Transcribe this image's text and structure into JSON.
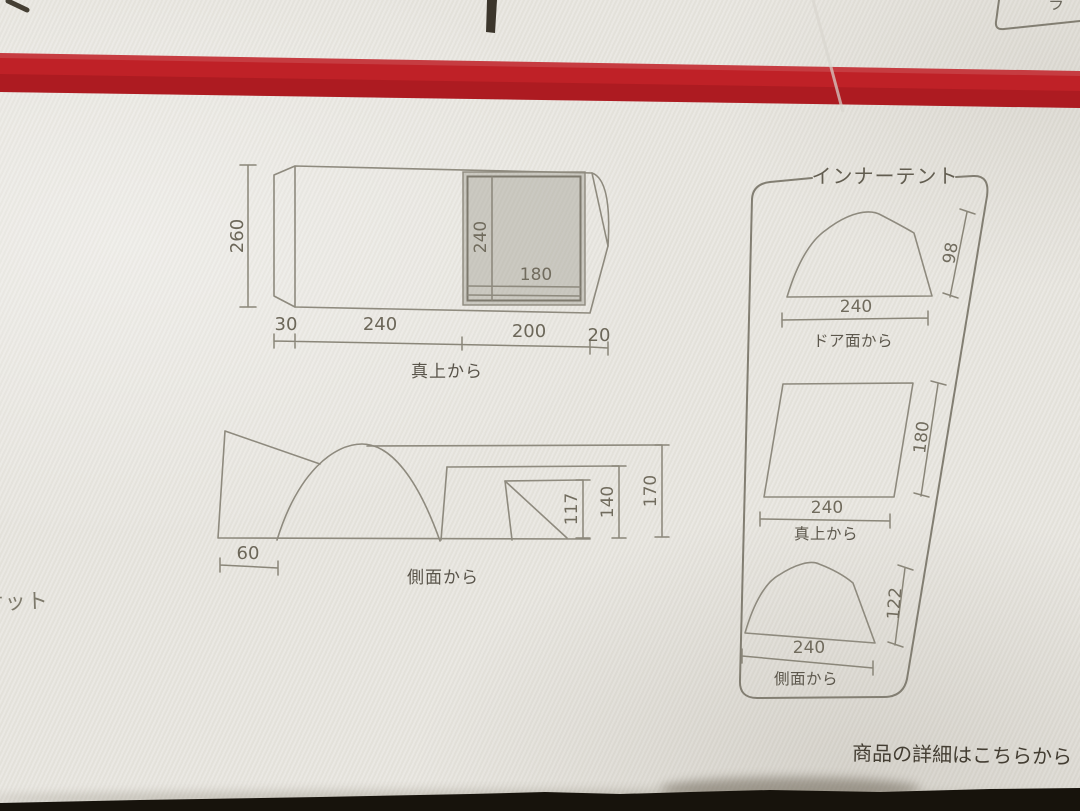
{
  "colors": {
    "stripe_red": "#bf2127",
    "bag_trim_black": "#17130c"
  },
  "photo": {
    "top_right_partial_label": "ラ",
    "left_partial_label": "ケット",
    "bottom_note": "商品の詳細はこちらから"
  },
  "top_view": {
    "caption": "真上から",
    "height": "260",
    "inner_height": "240",
    "inner_width": "180",
    "bottom_segments": [
      "30",
      "240",
      "200",
      "20"
    ]
  },
  "side_view": {
    "caption": "側面から",
    "front_width": "60",
    "heights": [
      "117",
      "140",
      "170"
    ]
  },
  "inner_tent": {
    "title": "インナーテント",
    "door_view": {
      "width": "240",
      "height": "98",
      "caption": "ドア面から"
    },
    "top_view": {
      "width": "240",
      "depth": "180",
      "caption": "真上から"
    },
    "side_view": {
      "width": "240",
      "height": "122",
      "caption": "側面から"
    }
  }
}
